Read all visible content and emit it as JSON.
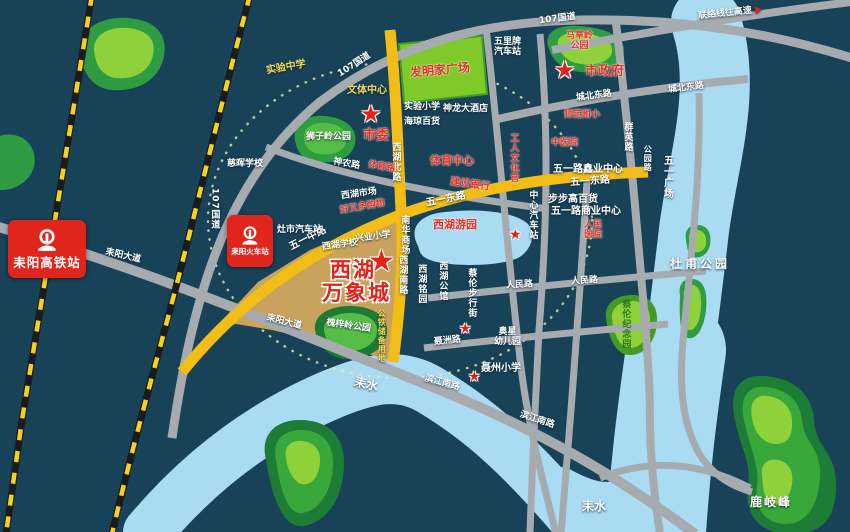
{
  "colors": {
    "background": "#184258",
    "river": "#a9dbf3",
    "road_gray": "#a6abb0",
    "road_yellow": "#f2bd16",
    "railway_yellow": "#f5d21b",
    "park_green": "#3eae3e",
    "landmark_tan": "#c9a25d",
    "poi_red": "#e2301f",
    "badge_red": "#e0261c"
  },
  "icons": {
    "star": "★",
    "arrow": "▶"
  },
  "badges": {
    "gaotie": "耒阳高铁站",
    "huoche": "耒阳火车站"
  },
  "landmark": {
    "top": "西湖",
    "bottom": "万象城"
  },
  "roads": {
    "g107": "107国道",
    "lianluo": "联络线往高速",
    "chengbei": "城北东路",
    "qunying": "群英路",
    "gongyuanlu": "公园路",
    "leiyang_dadao": "耒阳大道",
    "binjiang_nan": "滨江南路",
    "wuyi_zhong": "五一中路",
    "wuyi_dong": "五一东路",
    "xihu_bei": "西湖北路",
    "xihu_nan": "西湖南路",
    "shennong": "神农路",
    "tiyu_lu": "体育路",
    "renmin": "人民路",
    "niezhou_lu": "聂洲路"
  },
  "pois": {
    "shiwei": "市委",
    "shizhengfu": "市政府",
    "shiyan_zhongxue": "实验中学",
    "wenti_zhongxin": "文体中心",
    "famingjia": "发明家广场",
    "wulipai_l1": "五里牌",
    "wulipai_l2": "汽车站",
    "shiyan_xiaoxue": "实验小学",
    "shenlong": "神龙大酒店",
    "haiqiong": "海琼百货",
    "cihui": "慈晖学校",
    "shifan_fuxiao": "师范附小",
    "zhongyiyuan": "中医院",
    "tiyu_zhongxin": "体育中心",
    "jianshe_yinhang": "建设银行",
    "gongren_wenhuagong": "工人文化宫",
    "zhongxin_qichezhan": "中心汽车站",
    "wuyilu_xinye": "五一路鑫业中心",
    "bubugao": "步步高百货",
    "wuyilu_shangye": "五一路商业中心",
    "renmin_yiyuan_l1": "人民",
    "renmin_yiyuan_l2": "医院",
    "wuyi_guangchang": "五一广场",
    "xihu_shichang": "西湖市场",
    "haoyouduo": "好又多购物",
    "zaoshi_qichezhan": "灶市汽车站",
    "xihu_xuexiao": "西湖学校",
    "xingye_xiaoxue": "兴业小学",
    "nanhua_shangchang": "南华商场",
    "xihu_youyuan": "西湖游园",
    "xihu_mingyuan": "西湖铭园",
    "xihu_gongguan": "西湖公馆",
    "cailun_buxingjie": "蔡伦步行街",
    "aoxing_l1": "奥星",
    "aoxing_l2": "幼儿园",
    "niezhou_xiaoxue": "聂州小学",
    "gongtie": "公铁储备用地"
  },
  "parks": {
    "shiziling": "狮子岭公园",
    "macaoling_l1": "马草岭",
    "macaoling_l2": "公园",
    "huaiziling": "槐梓岭公园",
    "cailun_jinianyuan": "蔡伦纪念园",
    "dufu": "杜甫公园",
    "luqifeng": "鹿岐峰"
  },
  "water": {
    "name": "耒水"
  }
}
